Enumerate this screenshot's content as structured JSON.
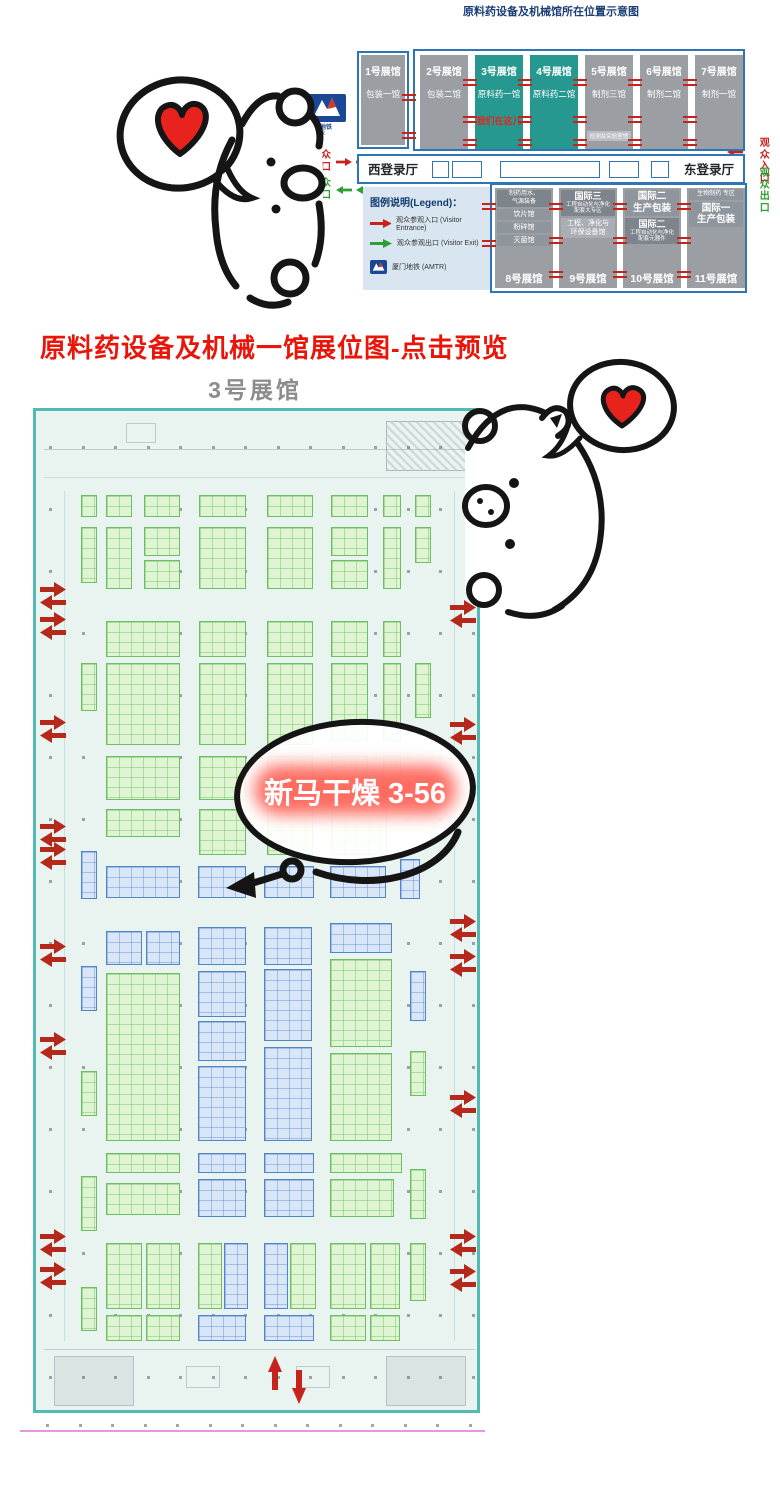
{
  "page": {
    "top_title": "原料药设备及机械馆所在位置示意图",
    "preview_link": "原料药设备及机械一馆展位图-点击预览",
    "hall_label": "3号展馆"
  },
  "overview": {
    "halls_top": [
      {
        "num": "1号展馆",
        "name": "包装一馆",
        "teal": false
      },
      {
        "num": "2号展馆",
        "name": "包装二馆",
        "teal": false
      },
      {
        "num": "3号展馆",
        "name": "原料药一馆",
        "teal": true,
        "note": "我们在这儿"
      },
      {
        "num": "4号展馆",
        "name": "原料药二馆",
        "teal": true
      },
      {
        "num": "5号展馆",
        "name": "制剂三馆",
        "teal": false,
        "sub": "检测及实验室馆"
      },
      {
        "num": "6号展馆",
        "name": "制剂二馆",
        "teal": false
      },
      {
        "num": "7号展馆",
        "name": "制剂一馆",
        "teal": false
      }
    ],
    "west_hall": "西登录厅",
    "east_hall": "东登录厅",
    "visitor_entrance": "观众入口",
    "visitor_exit": "观众出口",
    "legend": {
      "title": "图例说明(Legend)：",
      "entrance": "观众参观入口 (Visitor Entrance)",
      "exit": "观众参观出口 (Visitor Exit)",
      "metro": "厦门地铁 (AMTR)"
    },
    "metro_logo": {
      "line1": "厦门地铁",
      "line2": "AMTR"
    },
    "halls_bottom": [
      {
        "label": "8号展馆",
        "sections": [
          {
            "cls": "dk t6",
            "lines": [
              "制药用水、",
              "气源装备"
            ]
          },
          {
            "cls": "t7",
            "lines": [
              "饮片馆"
            ]
          },
          {
            "cls": "t7",
            "lines": [
              "粉碎馆"
            ]
          },
          {
            "cls": "t7",
            "lines": [
              "灭菌馆"
            ]
          }
        ]
      },
      {
        "label": "9号展馆",
        "sections": [
          {
            "cls": "dk mix",
            "lines": [
              "国际三",
              "工程自动化与净化",
              "配套大专区"
            ]
          },
          {
            "cls": "md t7",
            "lines": [
              "工程、净化与",
              "环保设备馆"
            ]
          }
        ]
      },
      {
        "label": "10号展馆",
        "sections": [
          {
            "cls": "big",
            "lines": [
              "国际二",
              "生产包装"
            ]
          },
          {
            "cls": "dk mix",
            "lines": [
              "国际二",
              "工程自动化与净化",
              "配套元器件"
            ]
          }
        ]
      },
      {
        "label": "11号展馆",
        "sections": [
          {
            "cls": "t6",
            "lines": [
              "生物制药 专区"
            ]
          },
          {
            "cls": "big",
            "lines": [
              "国际一",
              "生产包装"
            ]
          }
        ]
      }
    ]
  },
  "floor_plan": {
    "callout": "新马干燥 3-56",
    "booths": [
      [
        45,
        84,
        16,
        22,
        "g"
      ],
      [
        70,
        84,
        26,
        22,
        "g"
      ],
      [
        108,
        84,
        36,
        22,
        "g"
      ],
      [
        163,
        84,
        47,
        22,
        "g"
      ],
      [
        231,
        84,
        46,
        22,
        "g"
      ],
      [
        295,
        84,
        37,
        22,
        "g"
      ],
      [
        347,
        84,
        18,
        22,
        "g"
      ],
      [
        379,
        84,
        16,
        22,
        "g"
      ],
      [
        45,
        116,
        16,
        56,
        "g"
      ],
      [
        70,
        116,
        26,
        62,
        "g"
      ],
      [
        108,
        116,
        36,
        29,
        "g"
      ],
      [
        108,
        149,
        36,
        29,
        "g"
      ],
      [
        163,
        116,
        47,
        62,
        "g"
      ],
      [
        231,
        116,
        46,
        62,
        "g"
      ],
      [
        295,
        116,
        37,
        29,
        "g"
      ],
      [
        295,
        149,
        37,
        29,
        "g"
      ],
      [
        347,
        116,
        18,
        62,
        "g"
      ],
      [
        379,
        116,
        16,
        36,
        "g"
      ],
      [
        70,
        210,
        74,
        36,
        "g"
      ],
      [
        163,
        210,
        47,
        36,
        "g"
      ],
      [
        231,
        210,
        46,
        36,
        "g"
      ],
      [
        295,
        210,
        37,
        36,
        "g"
      ],
      [
        347,
        210,
        18,
        36,
        "g"
      ],
      [
        45,
        252,
        16,
        48,
        "g"
      ],
      [
        70,
        252,
        74,
        82,
        "g"
      ],
      [
        163,
        252,
        47,
        82,
        "g"
      ],
      [
        231,
        252,
        46,
        82,
        "g"
      ],
      [
        295,
        252,
        37,
        78,
        "g"
      ],
      [
        347,
        252,
        18,
        78,
        "g"
      ],
      [
        379,
        252,
        16,
        55,
        "g"
      ],
      [
        70,
        345,
        74,
        44,
        "g"
      ],
      [
        163,
        345,
        47,
        44,
        "g"
      ],
      [
        231,
        345,
        46,
        44,
        "g"
      ],
      [
        295,
        345,
        37,
        44,
        "g"
      ],
      [
        347,
        345,
        18,
        44,
        "g"
      ],
      [
        70,
        398,
        74,
        28,
        "g"
      ],
      [
        163,
        398,
        47,
        46,
        "g"
      ],
      [
        231,
        398,
        46,
        46,
        "g"
      ],
      [
        295,
        398,
        56,
        46,
        "g"
      ],
      [
        45,
        440,
        16,
        48,
        "b"
      ],
      [
        70,
        455,
        74,
        32,
        "b"
      ],
      [
        162,
        455,
        48,
        32,
        "b"
      ],
      [
        228,
        455,
        50,
        32,
        "b"
      ],
      [
        294,
        455,
        56,
        32,
        "b"
      ],
      [
        364,
        448,
        20,
        40,
        "b"
      ],
      [
        70,
        520,
        36,
        34,
        "b"
      ],
      [
        110,
        520,
        34,
        34,
        "b"
      ],
      [
        162,
        516,
        48,
        38,
        "b"
      ],
      [
        228,
        516,
        48,
        38,
        "b"
      ],
      [
        294,
        512,
        62,
        30,
        "b"
      ],
      [
        45,
        555,
        16,
        45,
        "b"
      ],
      [
        70,
        562,
        74,
        168,
        "g"
      ],
      [
        162,
        560,
        48,
        46,
        "b"
      ],
      [
        162,
        610,
        48,
        40,
        "b"
      ],
      [
        162,
        655,
        48,
        75,
        "b"
      ],
      [
        228,
        558,
        48,
        72,
        "b"
      ],
      [
        228,
        636,
        48,
        94,
        "b"
      ],
      [
        294,
        548,
        62,
        88,
        "g"
      ],
      [
        294,
        642,
        62,
        88,
        "g"
      ],
      [
        374,
        560,
        16,
        50,
        "b"
      ],
      [
        374,
        640,
        16,
        45,
        "g"
      ],
      [
        45,
        660,
        16,
        45,
        "g"
      ],
      [
        70,
        742,
        74,
        20,
        "g"
      ],
      [
        162,
        742,
        48,
        20,
        "b"
      ],
      [
        228,
        742,
        50,
        20,
        "b"
      ],
      [
        294,
        742,
        72,
        20,
        "g"
      ],
      [
        45,
        765,
        16,
        55,
        "g"
      ],
      [
        70,
        772,
        74,
        32,
        "g"
      ],
      [
        162,
        768,
        48,
        38,
        "b"
      ],
      [
        228,
        768,
        50,
        38,
        "b"
      ],
      [
        294,
        768,
        64,
        38,
        "g"
      ],
      [
        374,
        758,
        16,
        50,
        "g"
      ],
      [
        70,
        832,
        36,
        66,
        "g"
      ],
      [
        110,
        832,
        34,
        66,
        "g"
      ],
      [
        162,
        832,
        24,
        66,
        "g"
      ],
      [
        188,
        832,
        24,
        66,
        "b"
      ],
      [
        228,
        832,
        24,
        66,
        "b"
      ],
      [
        254,
        832,
        26,
        66,
        "g"
      ],
      [
        294,
        832,
        36,
        66,
        "g"
      ],
      [
        334,
        832,
        30,
        66,
        "g"
      ],
      [
        374,
        832,
        16,
        58,
        "g"
      ],
      [
        45,
        876,
        16,
        44,
        "g"
      ],
      [
        70,
        904,
        36,
        26,
        "g"
      ],
      [
        110,
        904,
        34,
        26,
        "g"
      ],
      [
        162,
        904,
        48,
        26,
        "b"
      ],
      [
        228,
        904,
        50,
        26,
        "b"
      ],
      [
        294,
        904,
        36,
        26,
        "g"
      ],
      [
        334,
        904,
        30,
        26,
        "g"
      ]
    ],
    "edge_arrows_left_y": [
      182,
      212,
      315,
      419,
      442,
      539,
      632,
      829,
      862
    ],
    "edge_arrows_right_y": [
      200,
      317,
      514,
      549,
      690,
      829,
      864
    ]
  },
  "colors": {
    "navy_title": "#1c3e77",
    "red_heading": "#ea1509",
    "teal_hall": "#27988f",
    "gray_hall": "#9b9fa3",
    "map_border_blue": "#2f74b5",
    "plan_border_teal": "#53b9b4",
    "booth_green": "#6cbf63",
    "booth_blue": "#4f86c8",
    "entrance_red": "#cf1f1a",
    "exit_green": "#2e9e35",
    "callout_glow": "#ff5247"
  }
}
